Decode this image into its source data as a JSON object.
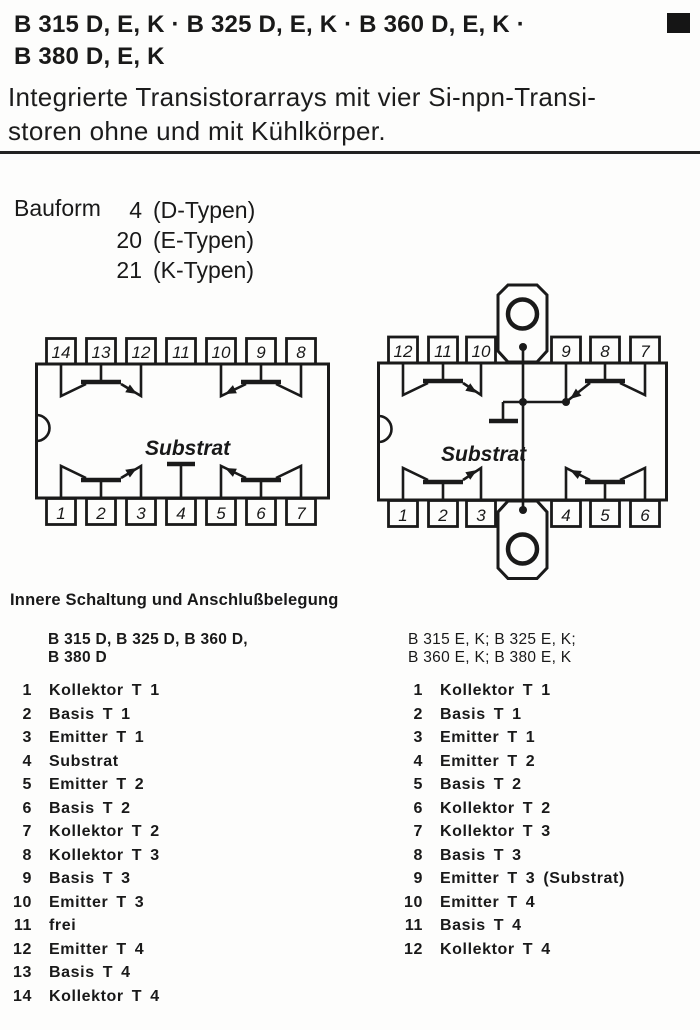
{
  "header": {
    "title_line1": "B 315 D, E, K · B 325 D, E, K · B 360 D, E, K ·",
    "title_line2": "B 380 D, E, K",
    "subtitle_line1": "Integrierte Transistorarrays mit vier Si-npn-Transi-",
    "subtitle_line2": "storen ohne und mit Kühlkörper.",
    "corner_mark": "filled-square"
  },
  "bauform": {
    "label": "Bauform",
    "rows": [
      {
        "num": "4",
        "desc": "(D-Typen)"
      },
      {
        "num": "20",
        "desc": "(E-Typen)"
      },
      {
        "num": "21",
        "desc": "(K-Typen)"
      }
    ]
  },
  "diagrams": {
    "dip14": {
      "top_pins": [
        "14",
        "13",
        "12",
        "11",
        "10",
        "9",
        "8"
      ],
      "bottom_pins": [
        "1",
        "2",
        "3",
        "4",
        "5",
        "6",
        "7"
      ],
      "substrate_label": "Substrat"
    },
    "heatsink": {
      "top_pins": [
        "12",
        "11",
        "10",
        "9",
        "8",
        "7"
      ],
      "bottom_pins": [
        "1",
        "2",
        "3",
        "4",
        "5",
        "6"
      ],
      "substrate_label": "Substrat"
    }
  },
  "pinout": {
    "heading": "Innere Schaltung und Anschlußbelegung",
    "left": {
      "header_line1": "B 315 D, B 325 D, B 360 D,",
      "header_line2": "B 380 D",
      "pins": [
        {
          "num": "1",
          "label": "Kollektor T 1"
        },
        {
          "num": "2",
          "label": "Basis T 1"
        },
        {
          "num": "3",
          "label": "Emitter T 1"
        },
        {
          "num": "4",
          "label": "Substrat"
        },
        {
          "num": "5",
          "label": "Emitter T 2"
        },
        {
          "num": "6",
          "label": "Basis T 2"
        },
        {
          "num": "7",
          "label": "Kollektor T 2"
        },
        {
          "num": "8",
          "label": "Kollektor T 3"
        },
        {
          "num": "9",
          "label": "Basis T 3"
        },
        {
          "num": "10",
          "label": "Emitter T 3"
        },
        {
          "num": "11",
          "label": "frei"
        },
        {
          "num": "12",
          "label": "Emitter T 4"
        },
        {
          "num": "13",
          "label": "Basis T 4"
        },
        {
          "num": "14",
          "label": "Kollektor T 4"
        }
      ]
    },
    "right": {
      "header_line1": "B 315 E, K; B 325 E, K;",
      "header_line2": "B 360 E, K; B 380 E, K",
      "pins": [
        {
          "num": "1",
          "label": "Kollektor T 1"
        },
        {
          "num": "2",
          "label": "Basis T 1"
        },
        {
          "num": "3",
          "label": "Emitter T 1"
        },
        {
          "num": "4",
          "label": "Emitter T 2"
        },
        {
          "num": "5",
          "label": "Basis T 2"
        },
        {
          "num": "6",
          "label": "Kollektor T 2"
        },
        {
          "num": "7",
          "label": "Kollektor T 3"
        },
        {
          "num": "8",
          "label": "Basis T 3"
        },
        {
          "num": "9",
          "label": "Emitter T 3 (Substrat)"
        },
        {
          "num": "10",
          "label": "Emitter T 4"
        },
        {
          "num": "11",
          "label": "Basis T 4"
        },
        {
          "num": "12",
          "label": "Kollektor T 4"
        }
      ]
    }
  },
  "colors": {
    "ink": "#191919",
    "paper": "#fdfdfc"
  }
}
